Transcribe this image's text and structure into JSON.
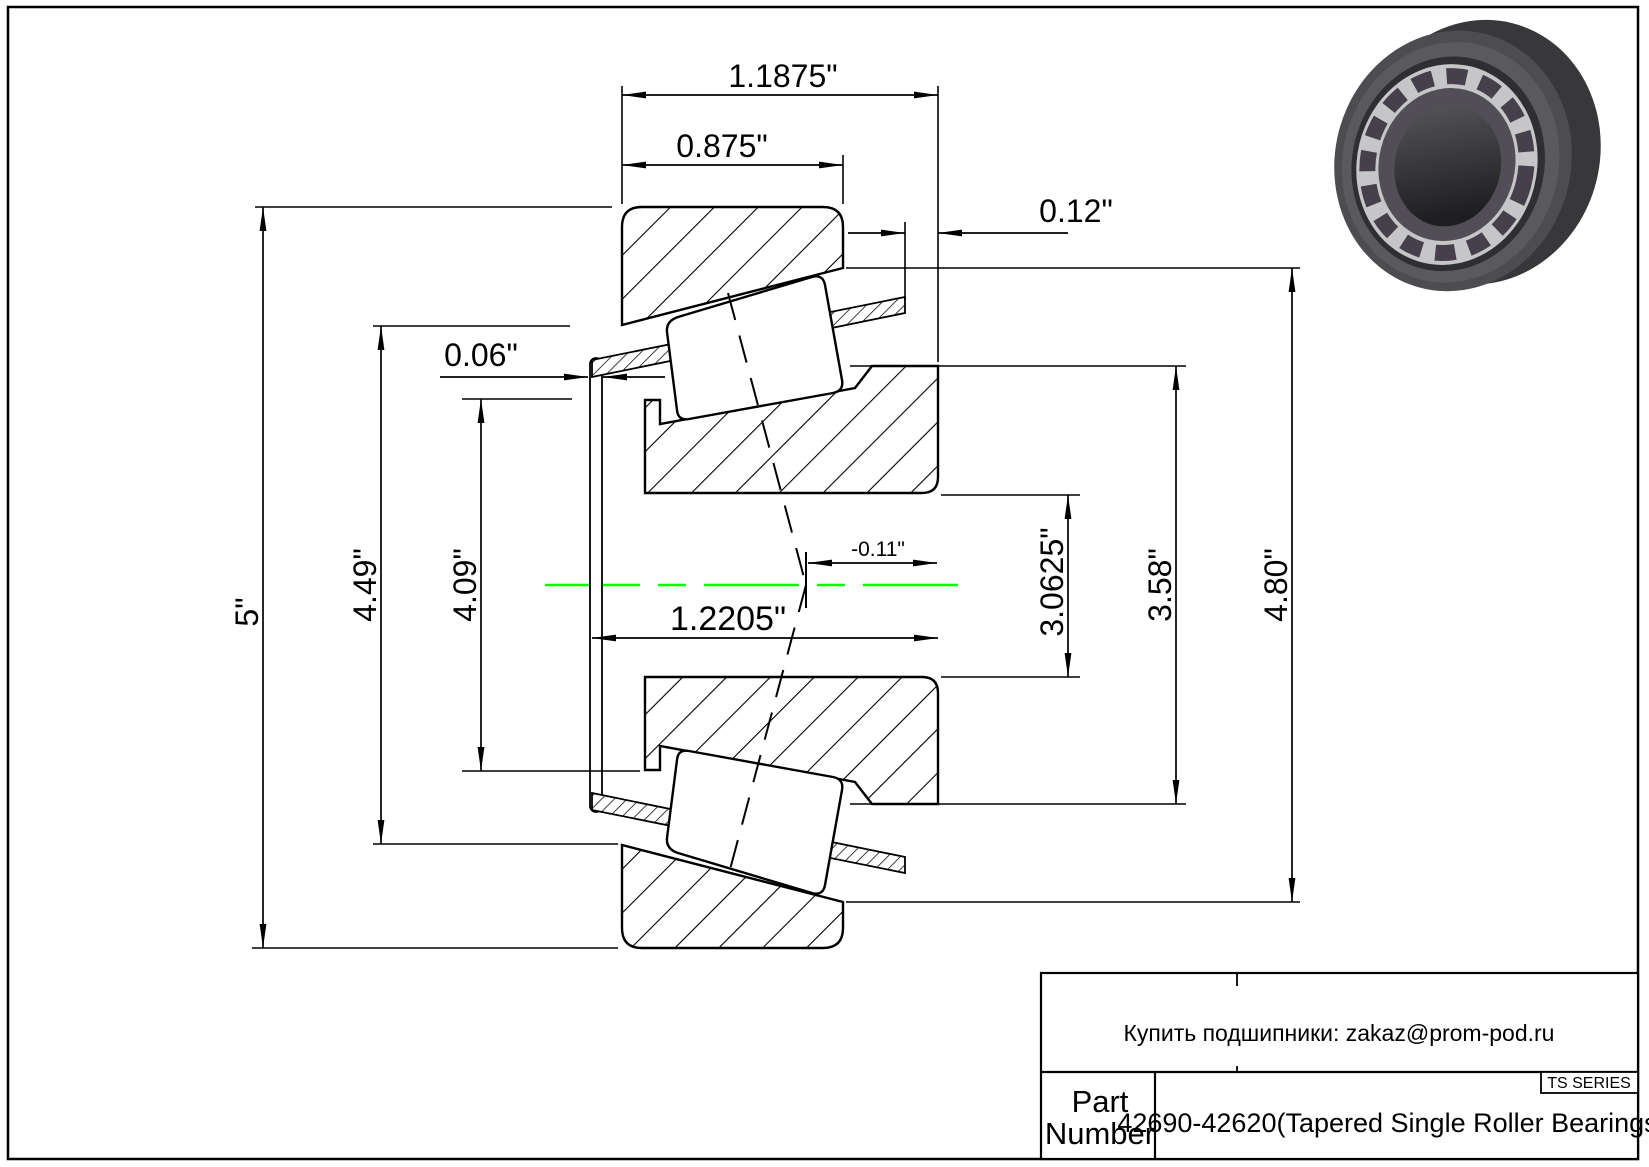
{
  "colors": {
    "line": "#000000",
    "centerline_green": "#00ff00",
    "background": "#ffffff",
    "render_ring_dark": "#3a3a3d",
    "render_ring_face": "#4d4d51",
    "render_cage_light": "#c6c6c8"
  },
  "dimensions": {
    "cone_width": "1.1875\"",
    "cup_width": "0.875\"",
    "back_face_offset": "0.12\"",
    "cage_front_lip": "0.06\"",
    "flange_od": "5\"",
    "cup_front_id": "4.49\"",
    "cone_front_rib_od": "4.09\"",
    "bore_diameter": "3.0625\"",
    "cone_back_rib_od": "3.58\"",
    "cup_od": "4.80\"",
    "effective_center": "-0.11\"",
    "cone_front_width": "1.2205\""
  },
  "title_block": {
    "contact_line": "Купить подшипники: zakaz@prom-pod.ru",
    "series_badge": "TS SERIES",
    "part_label_line1": "Part",
    "part_label_line2": "Number",
    "part_number": "42690-42620(Tapered Single Roller Bearings)"
  }
}
